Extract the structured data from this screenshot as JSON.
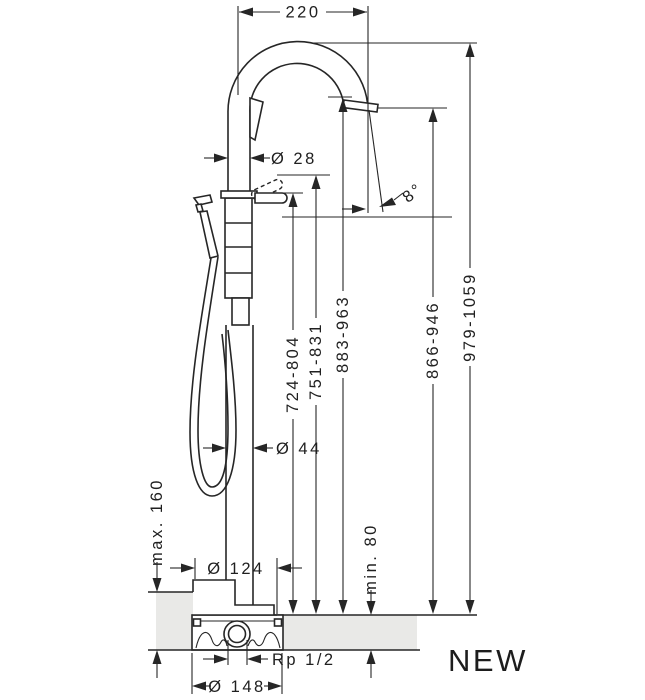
{
  "meta": {
    "badge": "NEW",
    "drawing_type": "freestanding bath mixer installation dimensions, side elevation"
  },
  "labels": {
    "reach": "220",
    "spout_diameter": "Ø 28",
    "spray_angle": "8°",
    "height_lever": "724-804",
    "height_lever_raised": "751-831",
    "height_spout_top": "883-963",
    "height_outlet": "866-946",
    "height_total": "979-1059",
    "column_diameter": "Ø 44",
    "escutcheon_diameter": "Ø 124",
    "install_depth_max": "max. 160",
    "install_depth_min": "min. 80",
    "thread": "Rp 1/2",
    "flange_diameter": "Ø 148"
  },
  "colors": {
    "line": "#262626",
    "floor_fill": "#e9e9e7",
    "background": "#ffffff"
  }
}
